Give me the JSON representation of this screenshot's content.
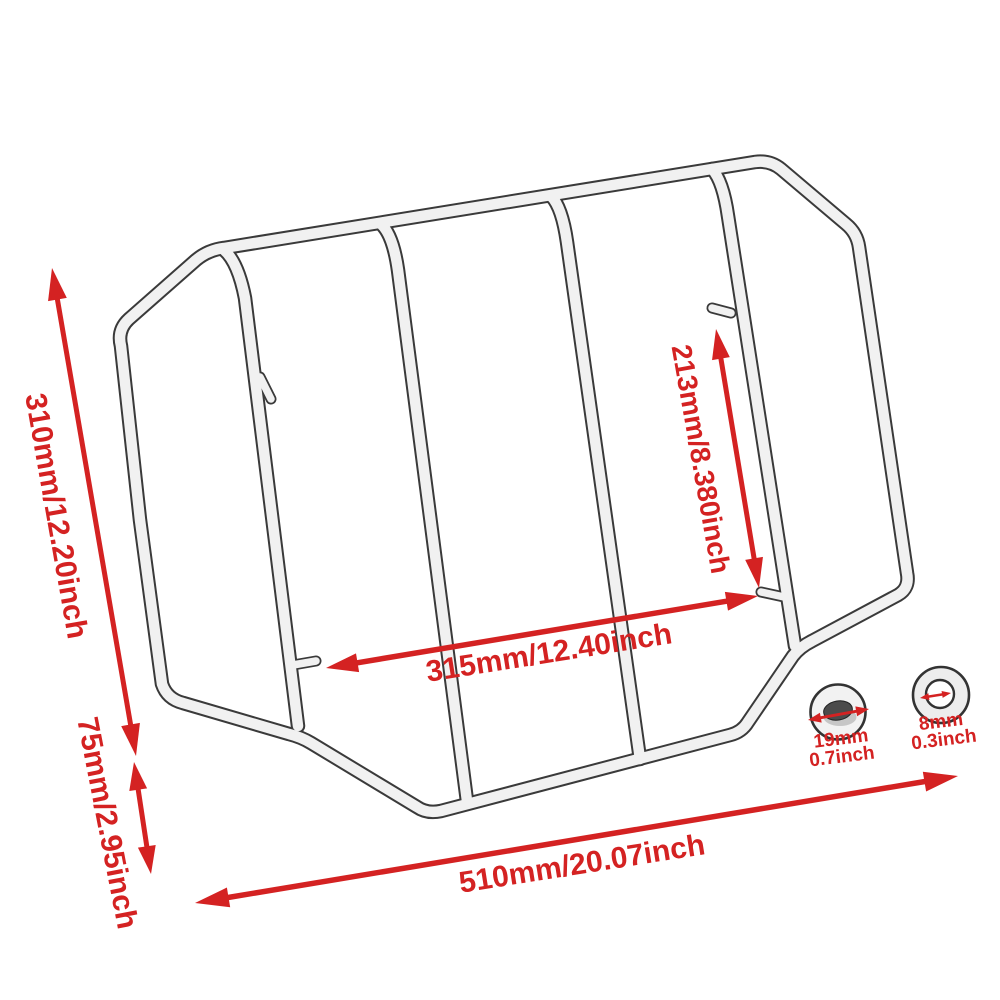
{
  "diagram": {
    "colors": {
      "dimension_red": "#d42222",
      "tube_outline": "#3a3a3a",
      "tube_fill": "#f1f1f1",
      "background": "#ffffff"
    },
    "dimensions": {
      "overall_height": {
        "label": "310mm/12.20inch"
      },
      "side_drop": {
        "label": "75mm/2.95inch"
      },
      "overall_width": {
        "label": "510mm/20.07inch"
      },
      "inner_width": {
        "label": "315mm/12.40inch"
      },
      "inner_height": {
        "label": "213mm/8.380inch"
      }
    },
    "details": {
      "tube_diameter": {
        "line1": "19mm",
        "line2": "0.7inch"
      },
      "hole_diameter": {
        "line1": "8mm",
        "line2": "0.3inch"
      }
    }
  }
}
